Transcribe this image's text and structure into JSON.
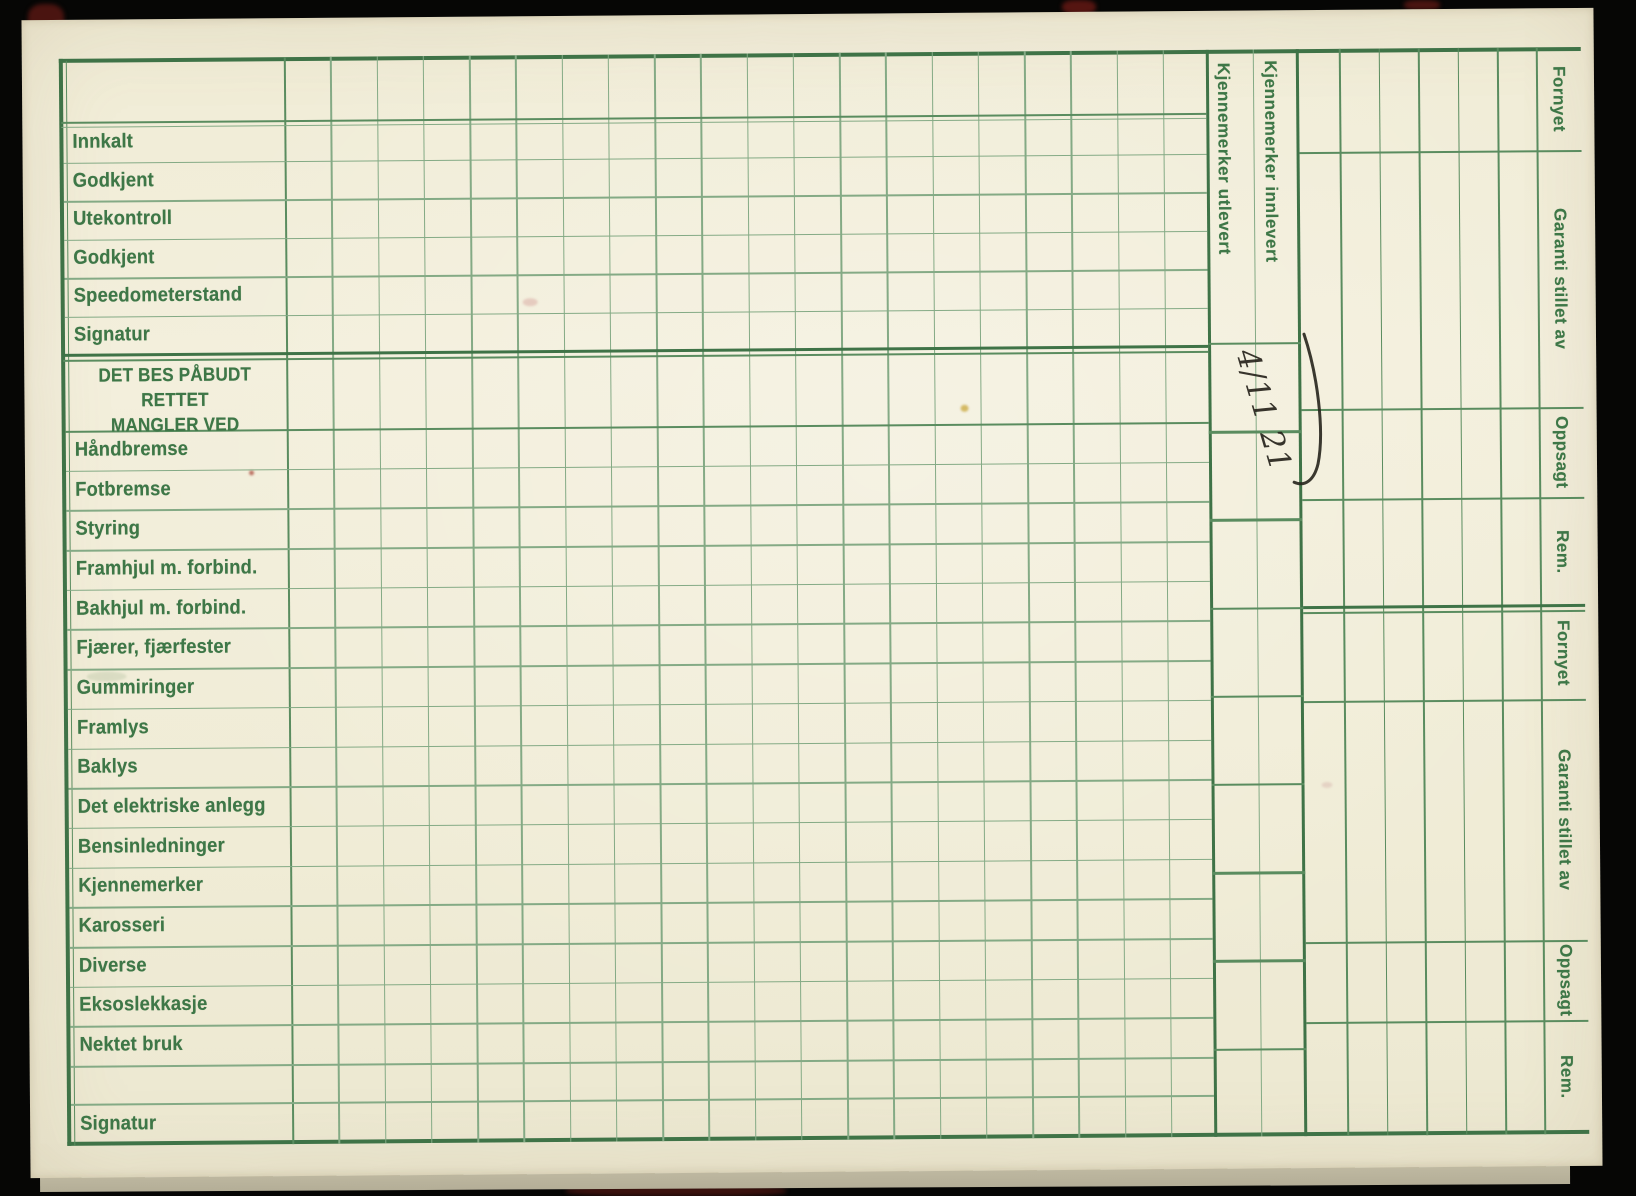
{
  "card": {
    "status_rows": [
      "Innkalt",
      "Godkjent",
      "Utekontroll",
      "Godkjent",
      "Speedometerstand",
      "Signatur"
    ],
    "defects_header": {
      "line1": "DET BES PÅBUDT RETTET",
      "line2": "MANGLER VED"
    },
    "defect_rows": [
      "Håndbremse",
      "Fotbremse",
      "Styring",
      "Framhjul m. forbind.",
      "Bakhjul m. forbind.",
      "Fjærer, fjærfester",
      "Gummiringer",
      "Framlys",
      "Baklys",
      "Det elektriske anlegg",
      "Bensinledninger",
      "Kjennemerker",
      "Karosseri",
      "Diverse",
      "Eksoslekkasje",
      "Nektet bruk"
    ],
    "signature_row": "Signatur",
    "plate_columns": {
      "issued": "Kjennemerker utlevert",
      "returned": "Kjennemerker innlevert"
    },
    "right_labels": [
      "Fornyet",
      "Garanti stillet av",
      "Oppsagt",
      "Rem.",
      "Fornyet",
      "Garanti stillet av",
      "Oppsagt",
      "Rem."
    ],
    "handwriting": "4/11 21",
    "colors": {
      "paper": "#f2eedb",
      "grid_green": "#4e8054",
      "grid_green_heavy": "#3f7347",
      "grid_green_thin": "#82a983",
      "text_green": "#3e7747",
      "ink": "#26231c"
    }
  }
}
